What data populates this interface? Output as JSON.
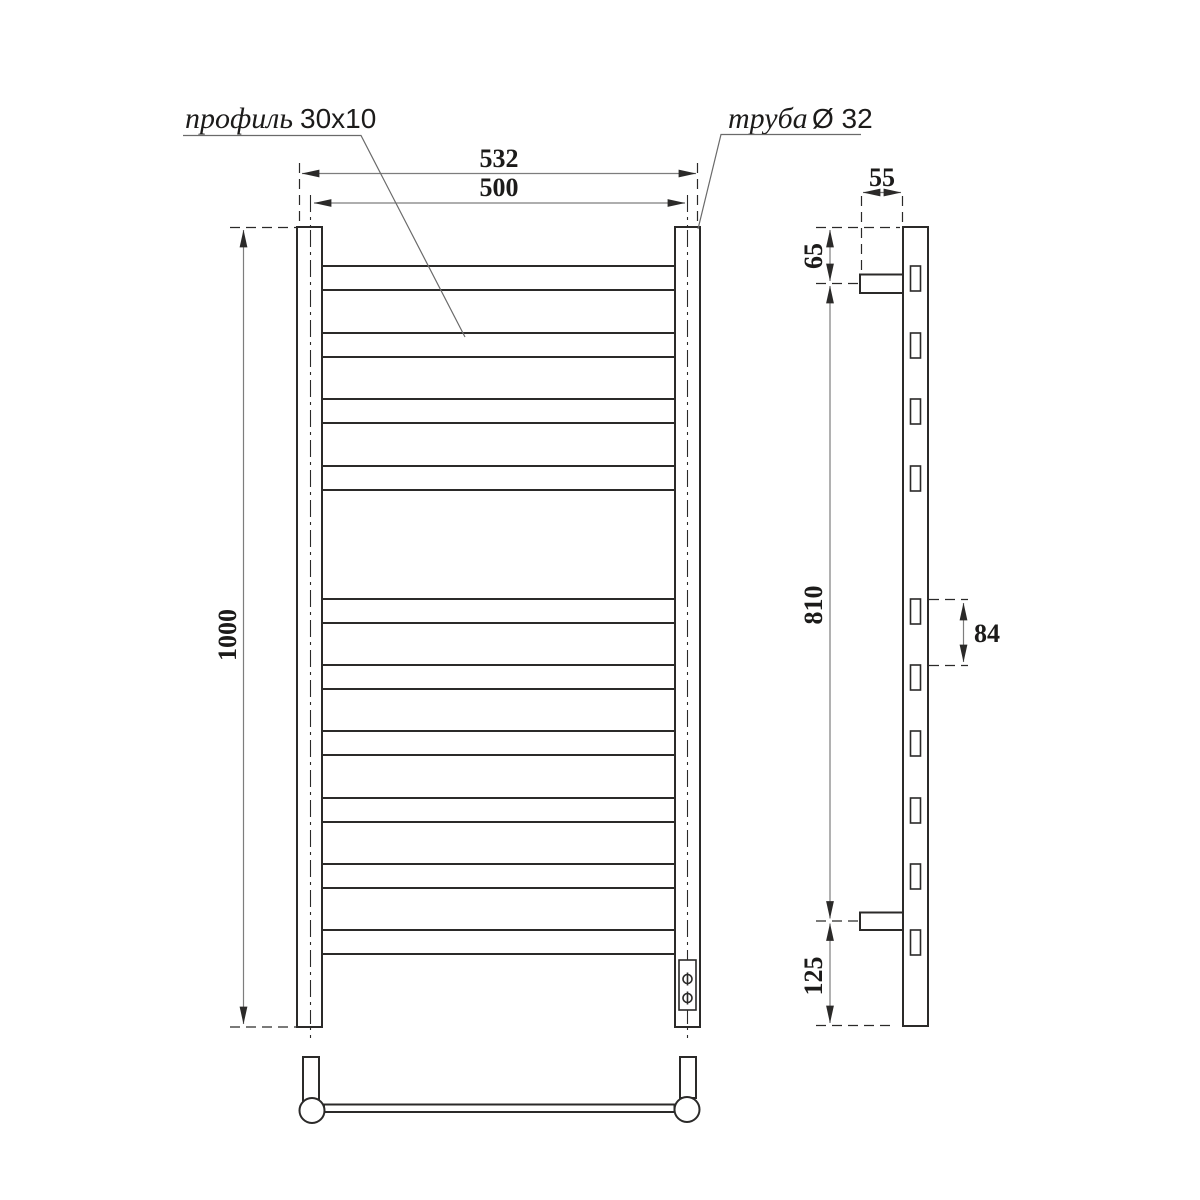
{
  "callouts": {
    "profile": {
      "label": "профиль",
      "value": "30x10"
    },
    "pipe": {
      "label": "труба",
      "value": "Ø 32"
    }
  },
  "dimensions": {
    "outer_width": "532",
    "axis_width": "500",
    "height": "1000",
    "bracket_depth": "55",
    "top_bracket_offset": "65",
    "bracket_span": "810",
    "rung_pitch": "84",
    "bottom_bracket_offset": "125"
  }
}
